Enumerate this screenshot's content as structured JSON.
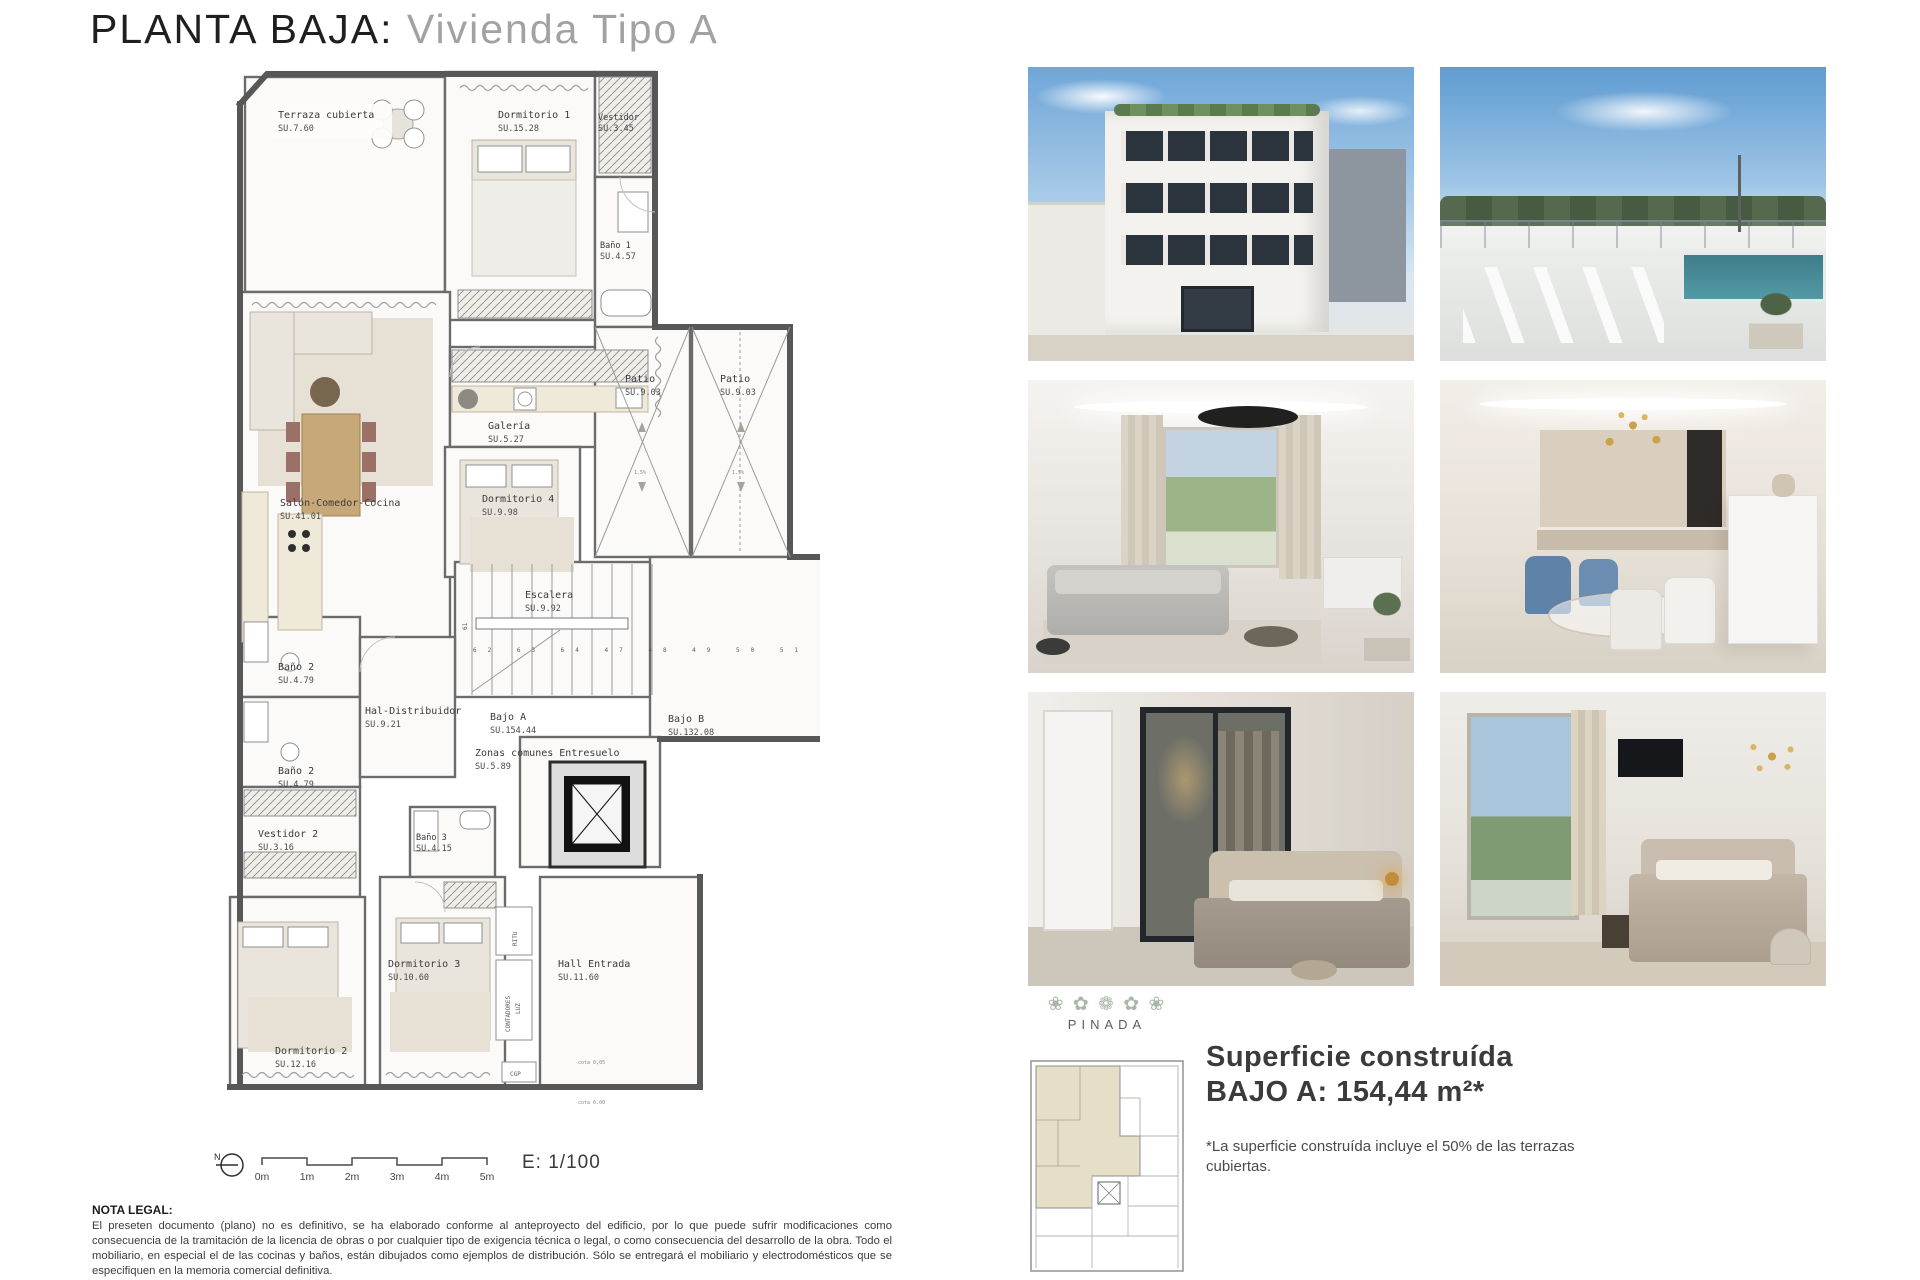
{
  "page": {
    "title_black": "PLANTA BAJA:",
    "title_gray": "Vivienda Tipo A"
  },
  "plan": {
    "rooms": [
      {
        "name": "Terraza cubierta",
        "area": "SU.7.60"
      },
      {
        "name": "Dormitorio 1",
        "area": "SU.15.28"
      },
      {
        "name": "Vestidor",
        "area": "SU.3.45"
      },
      {
        "name": "Baño 1",
        "area": "SU.4.57"
      },
      {
        "name": "Salón-Comedor-Cocina",
        "area": "SU.41.01"
      },
      {
        "name": "Galería",
        "area": "SU.5.27"
      },
      {
        "name": "Dormitorio 4",
        "area": "SU.9.98"
      },
      {
        "name": "Patio",
        "area": "SU.9.03"
      },
      {
        "name": "Patio",
        "area": "SU.9.03"
      },
      {
        "name": "Escalera",
        "area": "SU.9.92"
      },
      {
        "name": "Baño 2",
        "area": "SU.4.79"
      },
      {
        "name": "Baño 2",
        "area": "SU.4.79"
      },
      {
        "name": "Hal-Distribuidor",
        "area": "SU.9.21"
      },
      {
        "name": "Bajo A",
        "area": "SU.154.44"
      },
      {
        "name": "Zonas comunes Entresuelo",
        "area": "SU.5.89"
      },
      {
        "name": "Bajo B",
        "area": "SU.132.08"
      },
      {
        "name": "Vestidor 2",
        "area": "SU.3.16"
      },
      {
        "name": "Baño 3",
        "area": "SU.4.15"
      },
      {
        "name": "Dormitorio 3",
        "area": "SU.10.60"
      },
      {
        "name": "Dormitorio 2",
        "area": "SU.12.16"
      },
      {
        "name": "Hall Entrada",
        "area": "SU.11.60"
      }
    ],
    "utilities": {
      "ritu": "RITU",
      "contadores": "CONTADORES",
      "luz": "LUZ",
      "cgp": "CGP",
      "cota_top": "cota 0,05",
      "cota_bottom": "cota 0.00",
      "slope": "1.5%"
    },
    "stairs": {
      "top_number": "61",
      "run_numbers": "62 63 64 47 48 49 50 51 52"
    },
    "north_label": "N",
    "scale_ticks": [
      "0m",
      "1m",
      "2m",
      "3m",
      "4m",
      "5m"
    ],
    "scale_text": "E: 1/100"
  },
  "legal": {
    "heading": "NOTA LEGAL:",
    "body1": "El preseten documento (plano) no es definitivo, se ha elaborado conforme al anteproyecto del edificio, por lo que puede sufrir modificaciones como consecuencia de la tramitación de la licencia de obras o por cualquier tipo de exigencia técnica o legal, o como consecuencia del desarrollo de la obra. Todo el mobiliario, en especial el de las cocinas y baños, están dibujados como ejemplos de distribución. Sólo se entregará el mobiliario y electrodomésticos que se especifiquen en la memoria comercial definitiva.",
    "body2": "Es un plano meramente informativo, sin contenido contractual."
  },
  "sidebar": {
    "garland": "❀ ✿ ❁ ✿ ❀",
    "brand": "PINADA",
    "surface_line1": "Superficie construída",
    "surface_line2": "BAJO A: 154,44 m²*",
    "surface_note": "*La superficie construída incluye el 50% de las terrazas cubiertas."
  },
  "renders": [
    {
      "id": "building-exterior"
    },
    {
      "id": "roof-terrace-pool"
    },
    {
      "id": "living-room"
    },
    {
      "id": "dining-kitchen"
    },
    {
      "id": "bedroom-dressing"
    },
    {
      "id": "bedroom-window"
    }
  ],
  "colors": {
    "accent_sage": "#a9b8a5",
    "wall_gray": "#6b6b6b",
    "deck": "#d0c5b2",
    "patio": "#edeae4"
  }
}
